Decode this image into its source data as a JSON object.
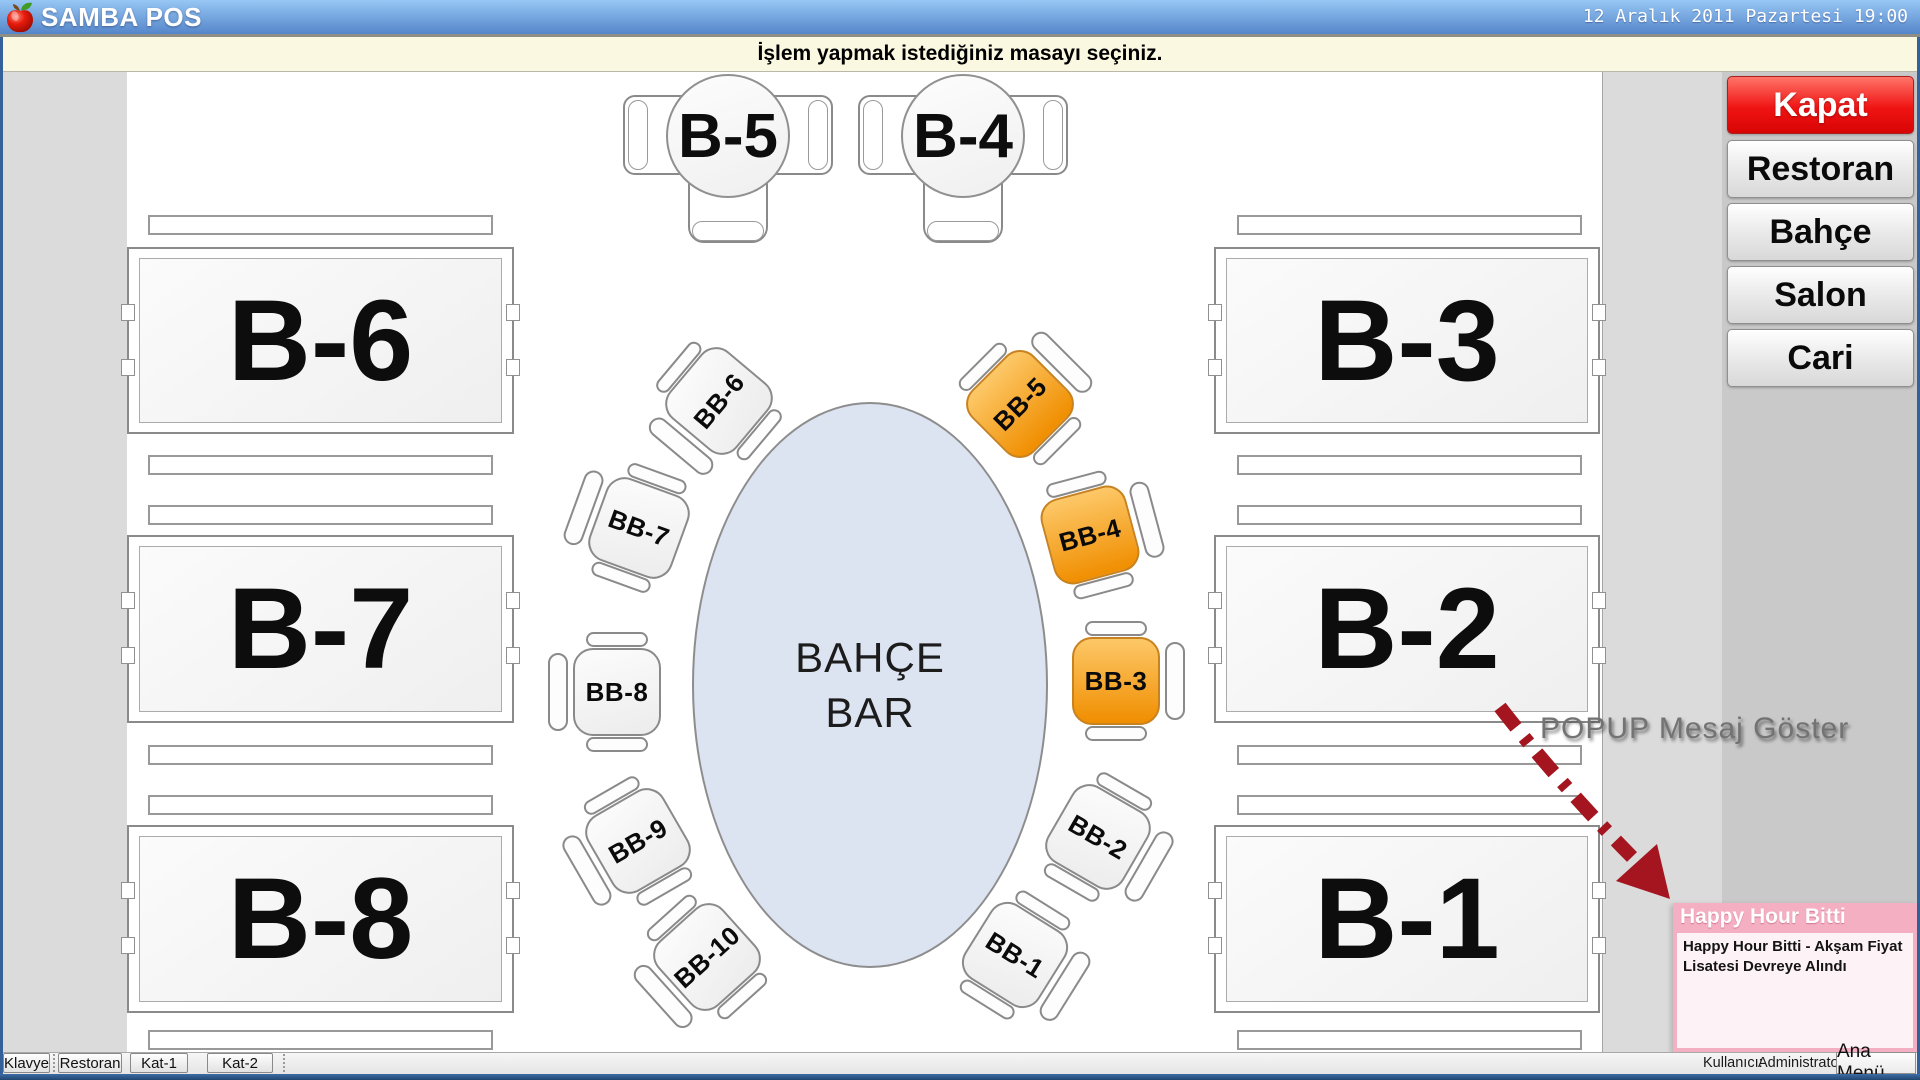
{
  "window": {
    "title": "SAMBA POS",
    "datetime": "12 Aralık 2011 Pazartesi 19:00"
  },
  "notification": {
    "message": "İşlem yapmak istediğiniz masayı seçiniz."
  },
  "sidebar": {
    "close_label": "Kapat",
    "sections": [
      "Restoran",
      "Bahçe",
      "Salon",
      "Cari"
    ]
  },
  "floor": {
    "bar": {
      "line1": "BAHÇE",
      "line2": "BAR"
    },
    "tables": {
      "b6": "B-6",
      "b7": "B-7",
      "b8": "B-8",
      "b3": "B-3",
      "b2": "B-2",
      "b1": "B-1",
      "b5": "B-5",
      "b4": "B-4"
    },
    "stools": {
      "bb6": {
        "label": "BB-6",
        "status": "free"
      },
      "bb7": {
        "label": "BB-7",
        "status": "free"
      },
      "bb8": {
        "label": "BB-8",
        "status": "free"
      },
      "bb9": {
        "label": "BB-9",
        "status": "free"
      },
      "bb10": {
        "label": "BB-10",
        "status": "free"
      },
      "bb5": {
        "label": "BB-5",
        "status": "occupied"
      },
      "bb4": {
        "label": "BB-4",
        "status": "occupied"
      },
      "bb3": {
        "label": "BB-3",
        "status": "occupied"
      },
      "bb2": {
        "label": "BB-2",
        "status": "free"
      },
      "bb1": {
        "label": "BB-1",
        "status": "free"
      }
    }
  },
  "annotation": {
    "text": "POPUP Mesaj Göster"
  },
  "popup": {
    "title": "Happy Hour Bitti",
    "message": "Happy Hour Bitti - Akşam Fiyat Lisatesi Devreye Alındı"
  },
  "bottom_bar": {
    "buttons": [
      "Klavye",
      "Restoran",
      "Kat-1",
      "Kat-2"
    ],
    "user_label": "Kullanıcı:",
    "user_value": "Administrator",
    "main_menu": "Ana Menü"
  },
  "colors": {
    "titlebar_top": "#97C7F4",
    "titlebar_bottom": "#5586CA",
    "border_blue": "#35619B",
    "kapat_top": "#FF7468",
    "kapat_bottom": "#D80404",
    "occupied_top": "#FDC868",
    "occupied_bottom": "#F08E00",
    "popup_frame": "#F5AFC3",
    "popup_body": "#FDF2F6",
    "arrow": "#A4151F",
    "bar_fill": "#DCE3F1"
  }
}
